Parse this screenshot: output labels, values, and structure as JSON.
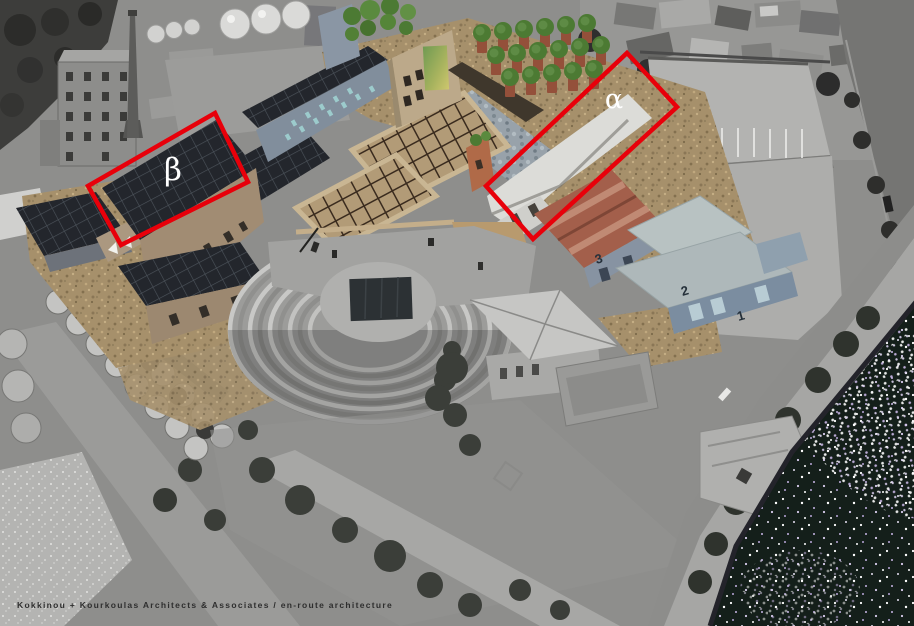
{
  "annotations": {
    "alpha": "α",
    "beta": "β",
    "outline_color": "#e8000a",
    "label_color": "#ffffff"
  },
  "building_numbers": [
    "3",
    "2",
    "1"
  ],
  "caption": {
    "text": "Kokkinou + Kourkoulas Architects & Associates / en-route architecture"
  },
  "colors": {
    "sea": "#141f1a",
    "gravel": "#a6906b",
    "dark_panel_roof": "#23262c",
    "red_roof": "#a35f4b",
    "blue_warehouse_wall": "#7b8da0",
    "annotation_red": "#e8000a"
  }
}
